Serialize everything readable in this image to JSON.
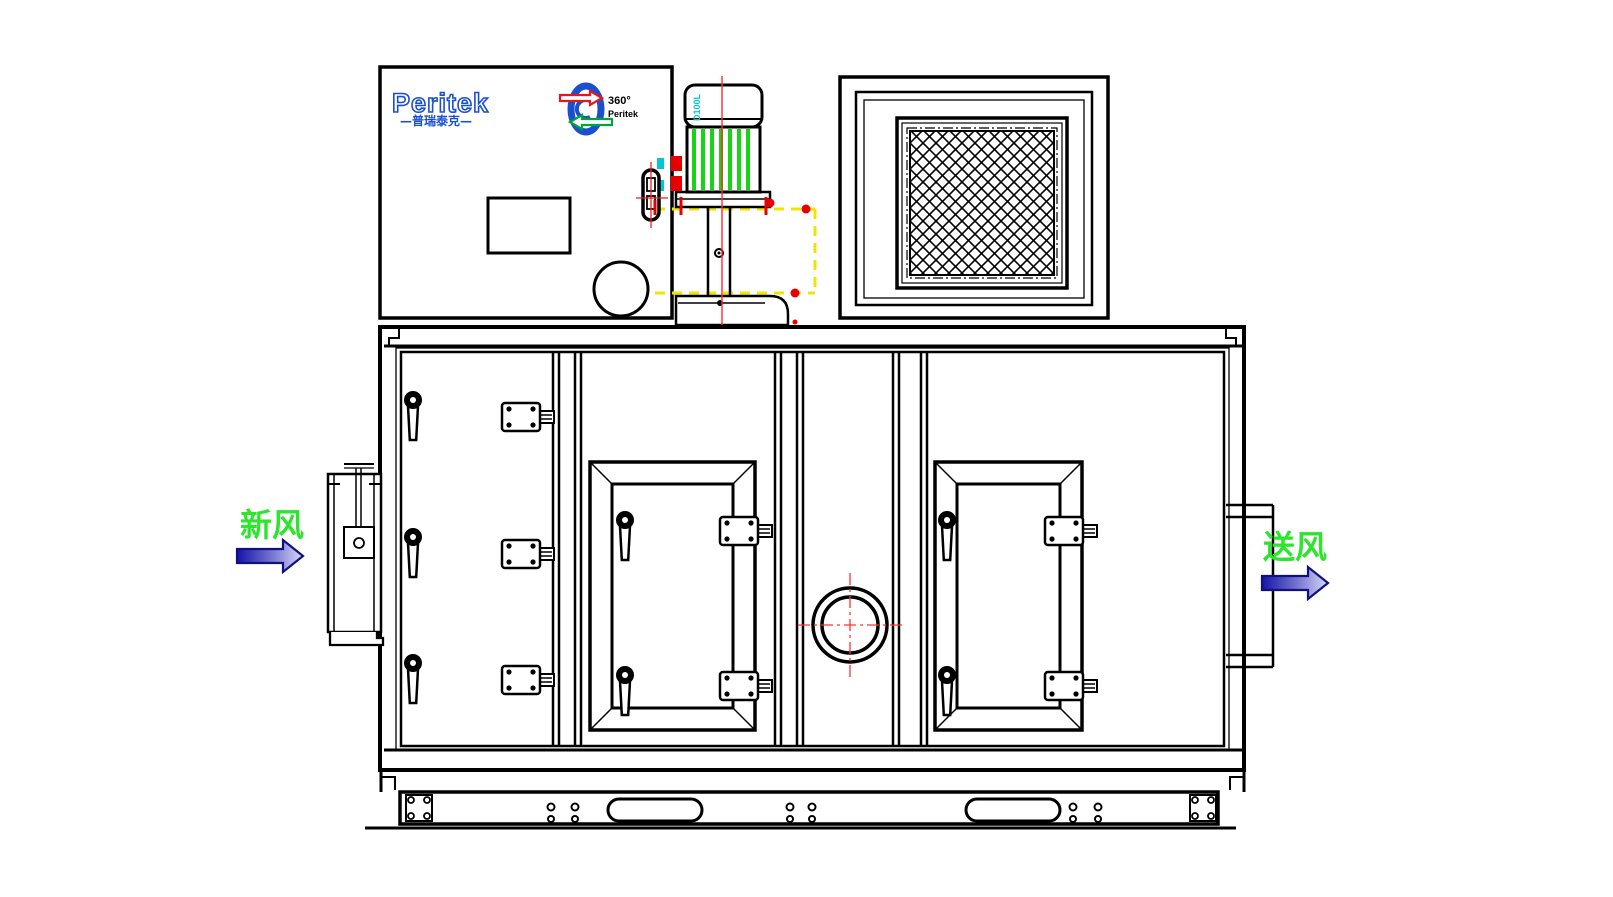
{
  "labels": {
    "inlet_air": "新风",
    "outlet_air": "送风"
  },
  "logo": {
    "brand": "Peritek",
    "brand_cn": "—普瑞泰克—",
    "rotor_degree": "360°",
    "rotor_brand": "Peritek"
  },
  "motor": {
    "model": "D100L"
  },
  "colors": {
    "line": "#000000",
    "accent_green": "#1ee01e",
    "accent_red": "#ee1111",
    "accent_yellow": "#f2e400",
    "accent_cyan": "#00c8d2",
    "brand_blue": "#1a4fd0",
    "arrow_dark": "#1515a8",
    "arrow_light": "#d8d8f8"
  }
}
